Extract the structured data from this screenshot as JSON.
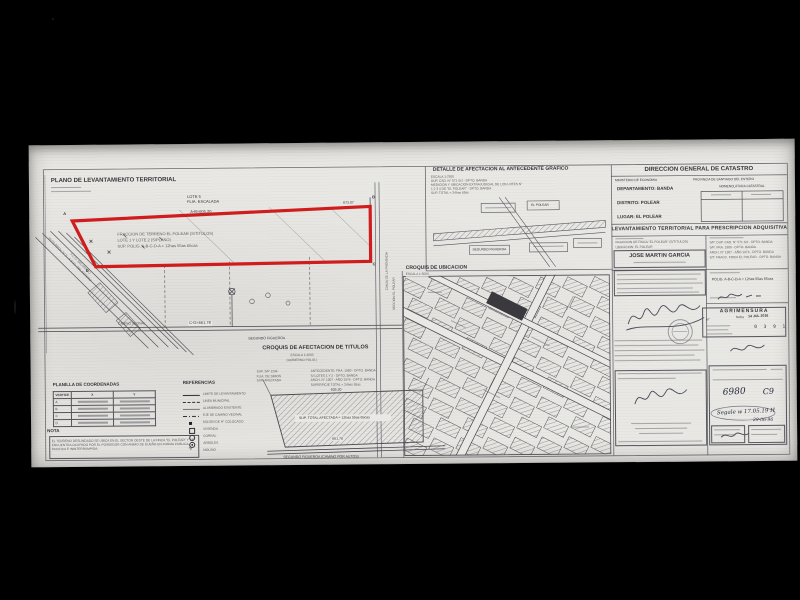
{
  "colors": {
    "paper": "#e9e8e4",
    "ink": "#35353a",
    "parcel_red": "#cf1d1d"
  },
  "main_plan": {
    "title": "PLANO DE LEVANTAMIENTO TERRITORIAL",
    "lote_label": "LOTE 5",
    "familia_label": "FLIA. ESCALADA",
    "dim_ab": "A-B=605.20",
    "dim_b_offset": "673.07",
    "vertex_a": "A",
    "vertex_b": "B",
    "vertex_c": "C",
    "vertex_d": "D",
    "parcel_line1": "FRACCION DE TERRENO EL POLEAR (S/TITULOS)",
    "parcel_line2": "LOTE 1 Y LOTE 2 (S/PLANO)",
    "parcel_line3": "SUP. POLIG. A-B-C-D-A = 12has 55as 65cas",
    "dim_cd": "C-D=661.78",
    "camino_label": "CAMINO VECINAL",
    "road_label": "SEGUNDO FIGUEROA",
    "diag_label1": "RUTA PROV. N° 5 - A SGO. DEL ESTERO",
    "diag_label2": "F.C.G. BELGRANO",
    "right_road_label": "ZANJA DE LA PROVINCIA",
    "right_road_label2": "SECCION EL POLEAR"
  },
  "detalle": {
    "title": "DETALLE DE AFECTACION AL ANTECEDENTE GRAFICO",
    "line1": "ESCALA 1:7500",
    "line2": "DUP. CAD. N° 571 S/J - DPTO. BANDA",
    "line3": "MEDICION Y UBICACION EXTRAJUDICIAL DE LOS LOTES N°",
    "line4": "1 2 3 4 DE \"EL POLEAR\" - DPTO. BANDA",
    "line5": "SUP. TOTAL = 24has 65as",
    "sketch_label1": "EL POLEAR",
    "sketch_label2": "SEGUNDO FIGUEROA"
  },
  "croquis_afectacion": {
    "title": "CROQUIS DE AFECTACION DE TITULOS",
    "subtitle1": "ESCALA 1:4000",
    "subtitle2": "(GOBIERNO POLIG.)",
    "left_line1": "SUP. S/P 1234",
    "left_line2": "FLIA. DE SIMON",
    "left_line3": "SUP. AFECTADA",
    "right_line1": "ANTECEDENTE: FRA. 1980 - DPTO. BANDA",
    "right_line2": "S/ LOTES 1 Y 2 - DPTO. BANDA",
    "right_line3": "ARCH. N° 1307 - AÑO 1974 - DPTO. BANDA",
    "right_line4": "SUPERFICIE TOTAL = 24has 65as",
    "inner_label": "SUP. TOTAL AFECTADA = 12has 55as 65cas",
    "dim_top": "605.20",
    "dim_bottom": "661.78",
    "bottom_label": "SEGUNDO FIGUEROA (CAMINO POR AUTOS)"
  },
  "croquis_ubicacion": {
    "title": "CROQUIS DE UBICACION",
    "subtitle": "ESCALA 1:5000"
  },
  "planilla": {
    "title": "PLANILLA DE COORDENADAS",
    "col_vertice": "VERTICE",
    "col_x": "X",
    "col_y": "Y",
    "rows": [
      {
        "v": "A"
      },
      {
        "v": "B"
      },
      {
        "v": "C"
      },
      {
        "v": "D"
      }
    ]
  },
  "referencias": {
    "title": "REFERENCIAS",
    "items": [
      "LIMITE DE LEVANTAMIENTO",
      "LINEA MUNICIPAL",
      "ALAMBRADO EXISTENTE",
      "EJE DE CAMINO VECINAL",
      "MOJON DE H° COLOCADO",
      "VIVIENDA",
      "CORRAL",
      "ARBOLES",
      "MOLINO"
    ]
  },
  "nota": {
    "title": "NOTA",
    "text": "EL TERRENO DESLINDADO SE UBICA EN EL SECTOR OESTE DE LA FINCA \"EL POLEAR\" Y SE ENCUENTRA OCUPADO POR EL POSEEDOR CON ANIMO DE DUEÑO EN FORMA PUBLICA, PACIFICA E ININTERRUMPIDA."
  },
  "header_panel": {
    "title": "DIRECCION  GENERAL  DE  CATASTRO",
    "ministerio": "MINISTERIO DE ECONOMIA",
    "provincia": "PROVINCIA DE SANTIAGO DEL ESTERO",
    "nomenclatura": "NOMENCLATURA CATASTRAL",
    "departamento": "DEPARTAMENTO: BANDA",
    "distrito": "DISTRITO: POLEAR",
    "lugar": "LUGAR:    EL POLEAR"
  },
  "levantamiento": {
    "banner": "LEVANTAMIENTO TERRITORIAL PARA PRESCRIPCION ADQUISITIVA",
    "objeto_line1": "FRACCION DE FINCA \"EL POLEAR\" (S/TITULOS)",
    "objeto_line2": "UBICACION: EL POLEAR",
    "poseedor": "JOSE MARTIN GARCIA",
    "ant_line1": "S/P: DUP. CAD. N° 571 S/J - DPTO. BANDA",
    "ant_line2": "S/P: FRA. 1980 - DPTO. BANDA",
    "ant_line3": "ARCH. N° 1307 - AÑO 1974 - DPTO. BANDA",
    "ant_line4": "S/T: FRACC. FINCA EL POLEAR - DPTO. BANDA",
    "superficie": "POLIG. A-B-C-D-A = 12has 55as 65cas"
  },
  "stamps": {
    "agrimensura": "AGRIMENSURA",
    "numero_label": "N°",
    "fecha_label": "fecha",
    "fecha_value": "14 JUL 2016",
    "registro": "0 3 9 1",
    "hand1": "6980",
    "hand2": "C9",
    "hand3": "Segale w 17.05.19 H",
    "hand4": "29-06-96"
  }
}
